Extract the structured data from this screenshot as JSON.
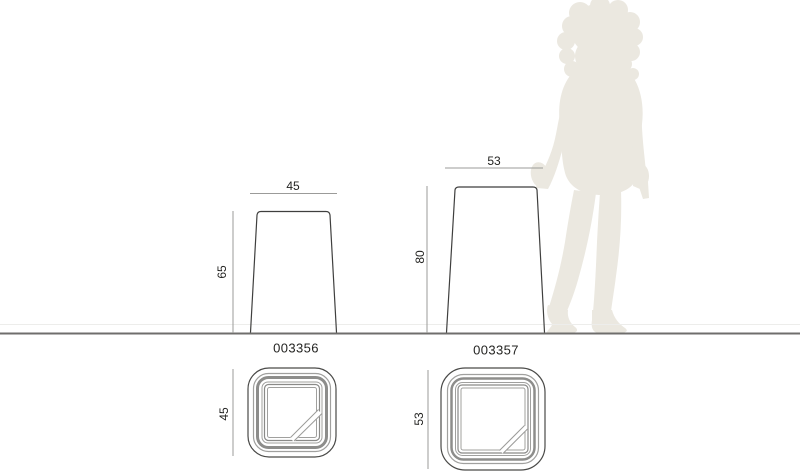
{
  "diagram": {
    "title_hint": "product-dimension-diagram",
    "units_shown": false,
    "colors": {
      "background": "#ffffff",
      "outline": "#3f3f3e",
      "dim_line": "#9b9b99",
      "ground_line": "#6f6e6c",
      "silhouette": "#ebe8e0",
      "text": "#232321"
    },
    "products": [
      {
        "code": "003356",
        "side_view": {
          "width": "45",
          "height": "65"
        },
        "top_view": {
          "size": "45"
        }
      },
      {
        "code": "003357",
        "side_view": {
          "width": "53",
          "height": "80"
        },
        "top_view": {
          "size": "53"
        }
      }
    ],
    "scale_figure": "female-silhouette"
  }
}
